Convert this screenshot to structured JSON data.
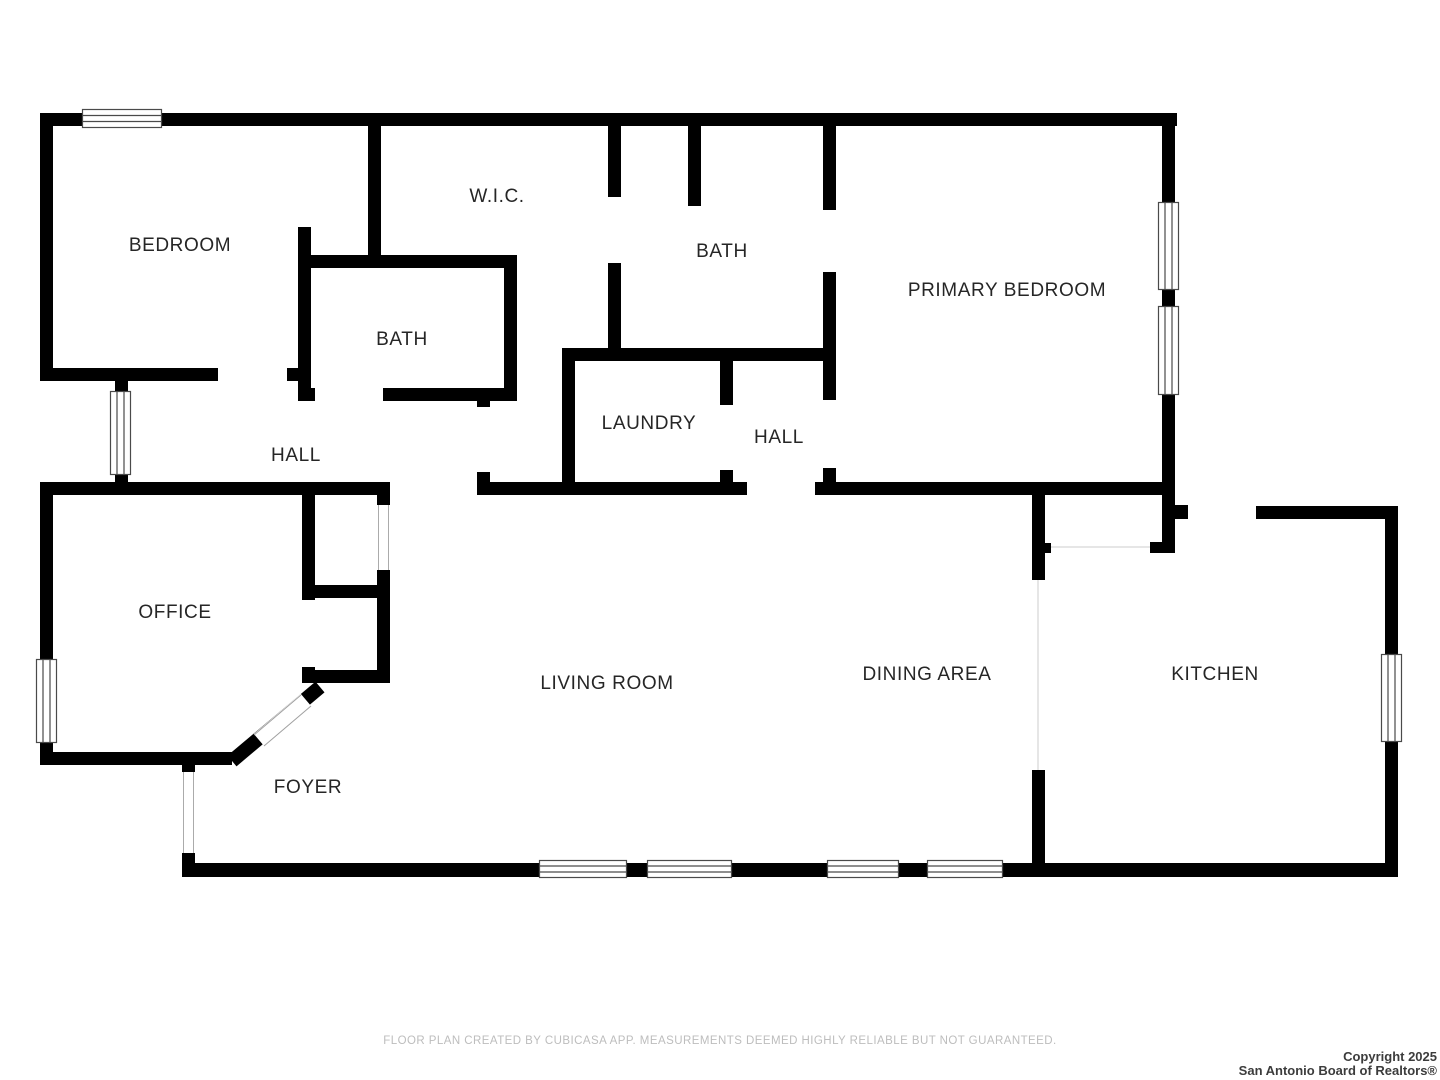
{
  "plan": {
    "rooms": [
      {
        "id": "bedroom",
        "label": "BEDROOM"
      },
      {
        "id": "wic",
        "label": "W.I.C."
      },
      {
        "id": "bath-upper",
        "label": "BATH"
      },
      {
        "id": "primary-bedroom",
        "label": "PRIMARY BEDROOM"
      },
      {
        "id": "bath-lower",
        "label": "BATH"
      },
      {
        "id": "laundry",
        "label": "LAUNDRY"
      },
      {
        "id": "hall-upper",
        "label": "HALL"
      },
      {
        "id": "hall-lower",
        "label": "HALL"
      },
      {
        "id": "office",
        "label": "OFFICE"
      },
      {
        "id": "living-room",
        "label": "LIVING ROOM"
      },
      {
        "id": "dining-area",
        "label": "DINING AREA"
      },
      {
        "id": "kitchen",
        "label": "KITCHEN"
      },
      {
        "id": "foyer",
        "label": "FOYER"
      }
    ]
  },
  "footer": {
    "disclaimer": "FLOOR PLAN CREATED BY CUBICASA APP. MEASUREMENTS DEEMED HIGHLY RELIABLE BUT NOT GUARANTEED."
  },
  "copyright": {
    "line1": "Copyright 2025",
    "line2": "San Antonio Board of Realtors®"
  },
  "colors": {
    "wall": "#000000",
    "label": "#262626",
    "disclaimer": "#bdbdbd",
    "copyright": "#3c3c3c",
    "window_frame": "#4a4a4a"
  }
}
